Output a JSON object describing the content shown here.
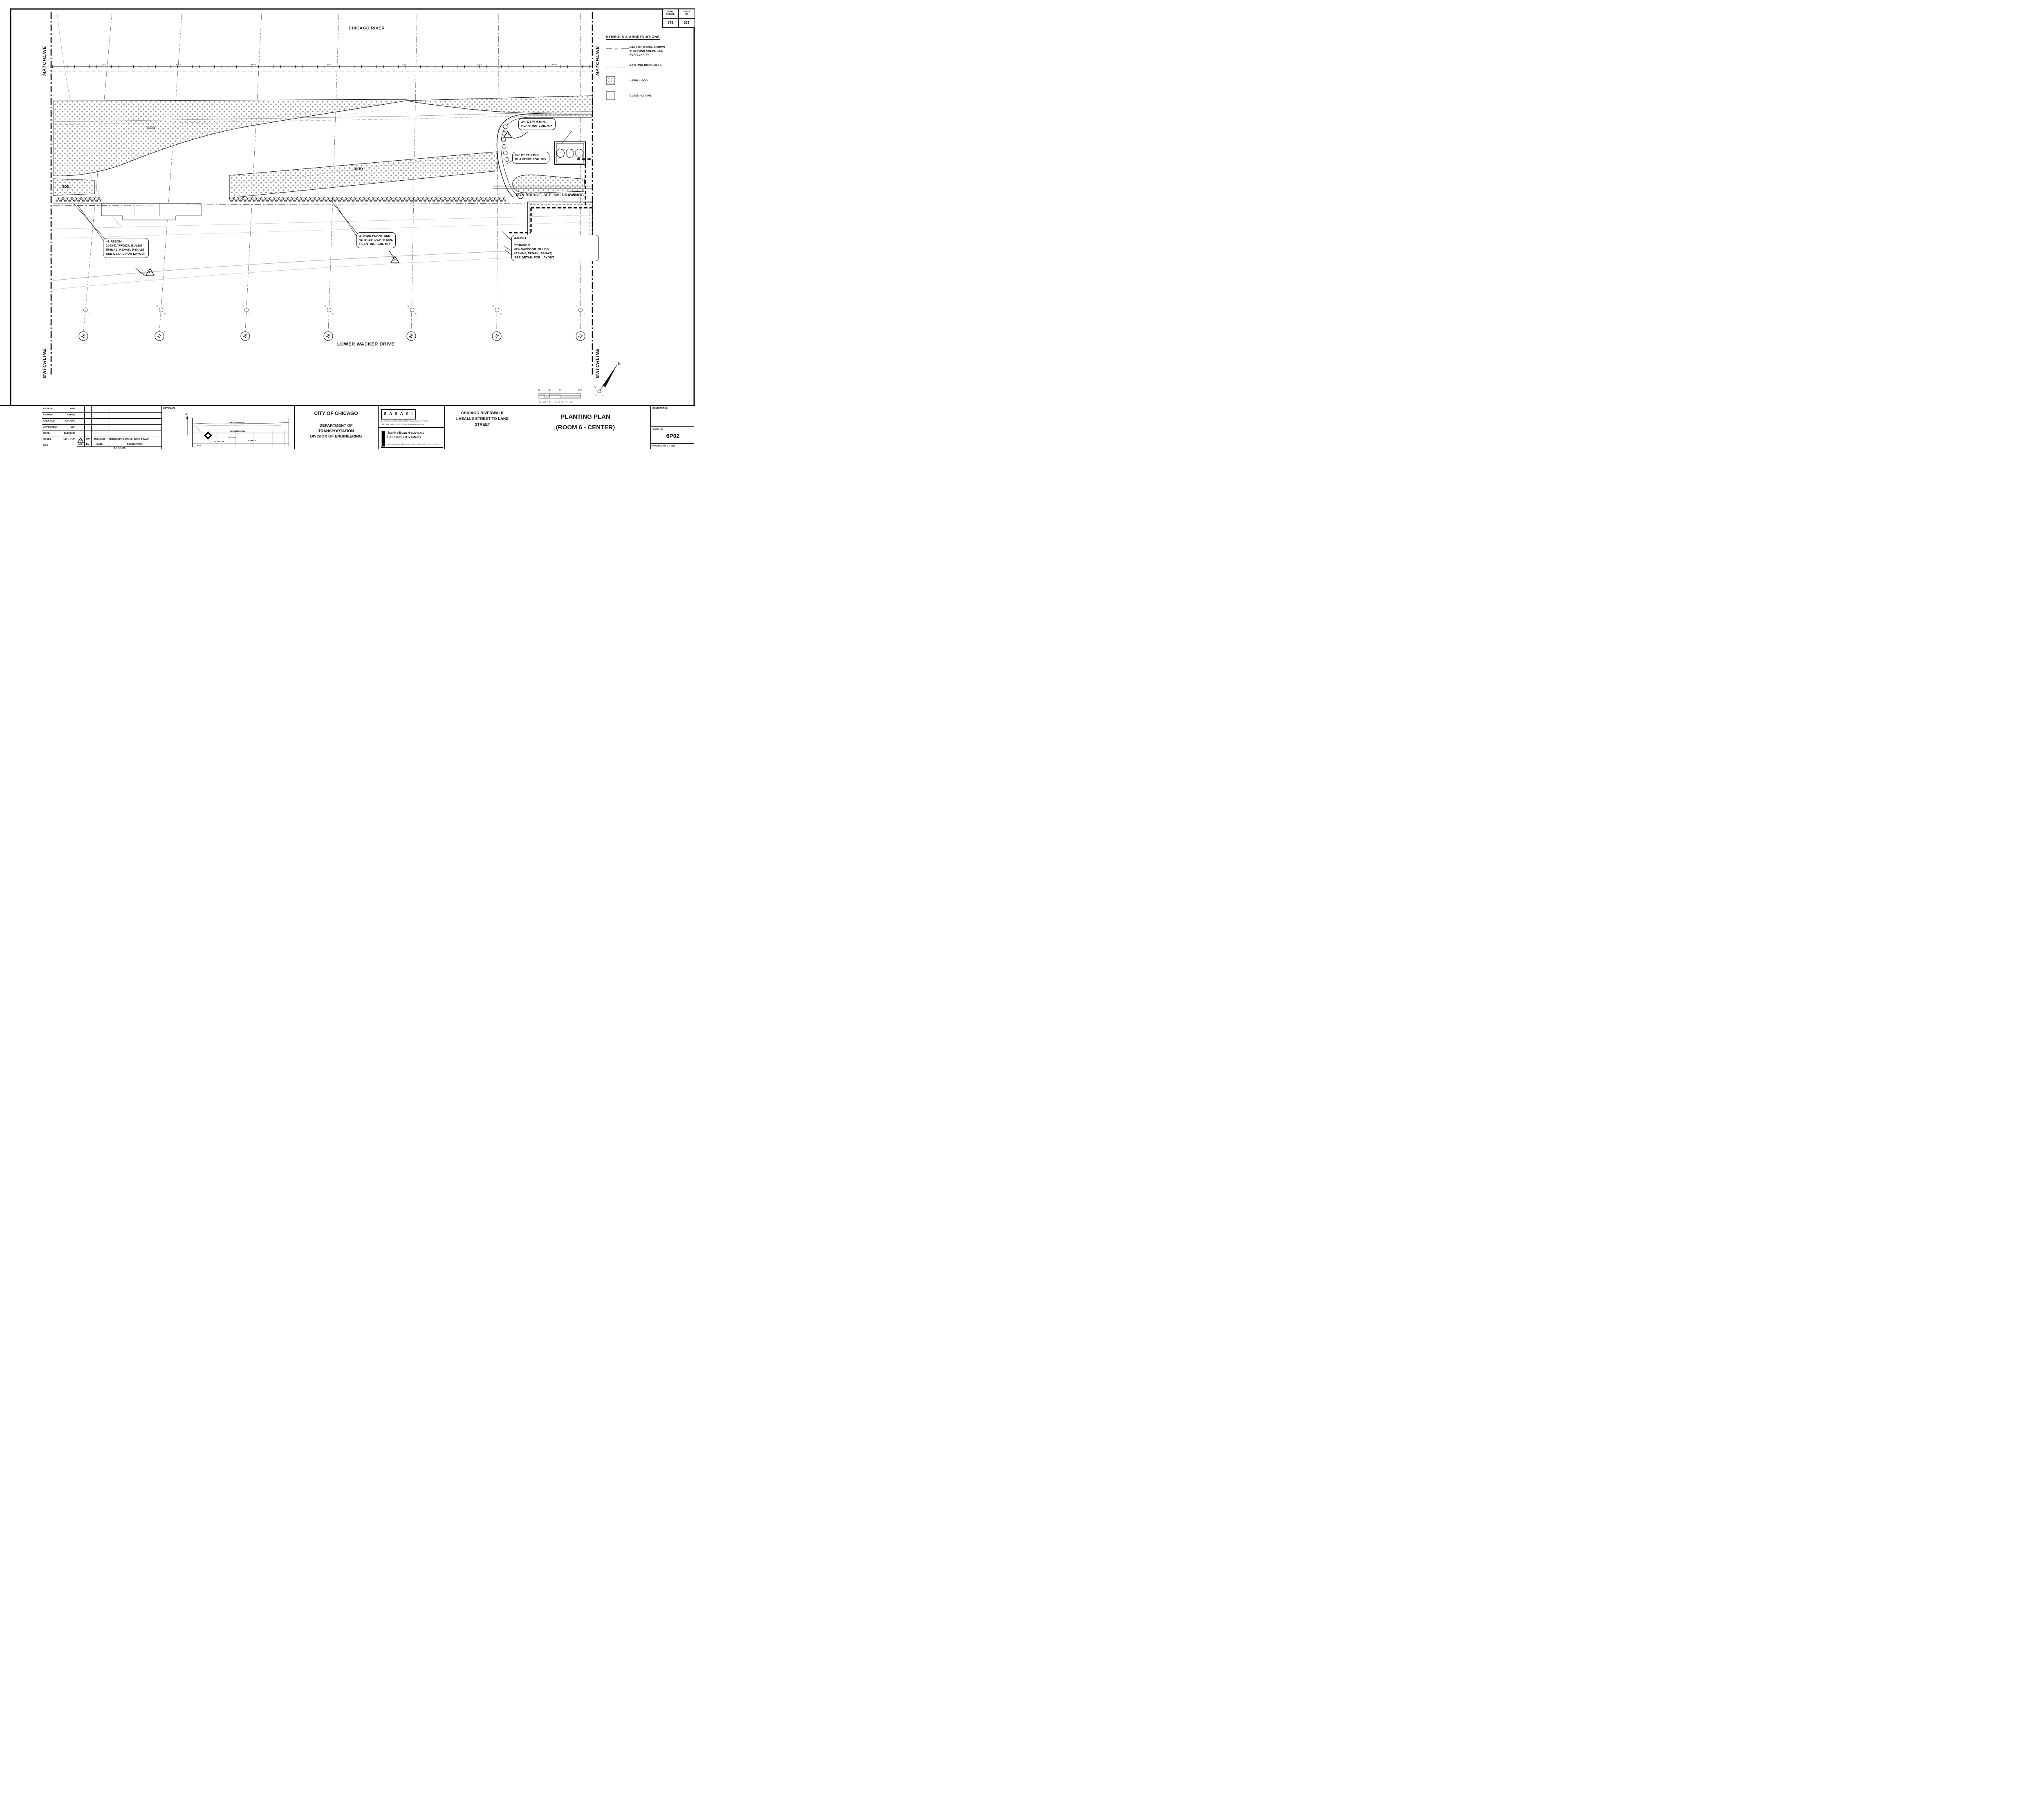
{
  "sheet_table": {
    "col1_header_l1": "TOTAL",
    "col1_header_l2": "SHEETS",
    "col2_header_l1": "SHEET",
    "col2_header_l2": "NO.",
    "total_sheets": "378",
    "sheet_no": "338"
  },
  "legend": {
    "title": "SYMBOLS & ABBREVIATIONS",
    "items": [
      {
        "lines": [
          "LIMIT OF WORK, SHOWN",
          "1' BEYOND VOLPE LINE",
          "FOR CLARITY"
        ]
      },
      {
        "lines": [
          "EXISTING DOCK EDGE"
        ]
      },
      {
        "lines": [
          "LAWN – SOD"
        ]
      },
      {
        "lines": [
          "CLIMBING VINE"
        ]
      }
    ]
  },
  "plan": {
    "river_label": "CHICAGO RIVER",
    "road_label": "LOWER WACKER DRIVE",
    "matchline_label": "MATCHLINE",
    "low_label": "LOW",
    "sod_big": "SOD",
    "sod_small": "SOD",
    "sod_mid": "SOD",
    "bridge_note": "FOR BRIDGE, SEE 'SM' DRAWINGS",
    "grid_bubbles": [
      "16",
      "17",
      "18",
      "19",
      "20",
      "21",
      "22"
    ],
    "revision_triangle": "14",
    "north_label": "N",
    "callouts": {
      "left": {
        "lines": [
          "43-R6SON",
          "1008-DAFFODIL BULBS",
          "(R6NAJ, R6NAK, R6NAS)",
          "SEE DETAIL FOR LAYOUT"
        ]
      },
      "mid": {
        "lines": [
          "2' WIDE PLANT BED",
          "WITH 24\" DEPTH MIN.",
          "PLANTING SOIL MIX"
        ]
      },
      "right_top": "4-R6VIJ",
      "right": {
        "lines": [
          "27-R6SON",
          "624-DAFFODIL BULBS",
          "(R6NAJ, R6NAK, R6NAS)",
          "SEE DETAIL FOR LAYOUT"
        ]
      },
      "soil_a": {
        "lines": [
          "24\" DEPTH MIN.",
          "PLANTING SOIL MIX"
        ]
      },
      "soil_b": {
        "lines": [
          "24\" DEPTH MIN.",
          "PLANTING SOIL MIX"
        ]
      }
    },
    "scale_bar": {
      "t0": "0'",
      "t1": "4'",
      "t2": "8'",
      "t3": "16'",
      "caption": "SCALE: 1/8\"= 1'-0\""
    }
  },
  "titleblock": {
    "info": [
      {
        "label": "DESIGN:",
        "value": "GMF"
      },
      {
        "label": "DRAWN:",
        "value": "CM/SW"
      },
      {
        "label": "CHECKED:",
        "value": "SMC/ZPC"
      },
      {
        "label": "APPROVED:",
        "value": "SEH"
      },
      {
        "label": "DATE:",
        "value": "10/17/2014"
      },
      {
        "label": "SCALE:",
        "value": "1/8\" = 1'-0\""
      },
      {
        "label": "FILE:",
        "value": ""
      }
    ],
    "revisions": {
      "entry": {
        "no": "14",
        "by": "SW",
        "date": "03/10/2016",
        "description": "DESIGN REVISION #14 - ROOM 6 RAMP"
      },
      "h_no": "NO.",
      "h_by": "BY",
      "h_date": "DATE",
      "h_desc": "DESCRIPTION",
      "footer": "REVISIONS"
    },
    "key_plan": {
      "label": "KEY PLAN:",
      "north": "N",
      "river": "CHICAGO RIVER",
      "wacker": "WACKER DRIVE",
      "wells": "WELLS",
      "lasalle": "LASALLE",
      "franklin": "FRANKLIN",
      "lake": "LAKE"
    },
    "agency": {
      "line1": "CITY OF CHICAGO",
      "line2": "DEPARTMENT OF",
      "line3": "TRANSPORTATION",
      "line4": "DIVISION OF ENGINEERING"
    },
    "consultants": {
      "sasaki_logo": "S A S A K I",
      "sasaki_address": "64 PLEASANT STREET, WATERTOWN, MA  02472  USA",
      "sasaki_contacts": "t 617 926 3300      f 617 924 2748      w www.sasaki.com",
      "jr_name1": "Jacobs/Ryan Associates",
      "jr_name2": "Landscape Architects",
      "jr_address": "1527 North Sandburg Terrace       Chicago , Illinois 60610       (312) 664-3217"
    },
    "project": {
      "line1": "CHICAGO RIVERWALK",
      "line2": "LASALLE STREET TO LAKE",
      "line3": "STREET"
    },
    "sheet_title": {
      "line1": "PLANTING PLAN",
      "line2": "(ROOM 6 - CENTER)"
    },
    "right": {
      "contract_label": "CONTRACT NO.",
      "sheet_label": "SHEET NO.",
      "sheet_no": "6P02",
      "project_no": "PROJECT NO. E-0-621b"
    }
  }
}
